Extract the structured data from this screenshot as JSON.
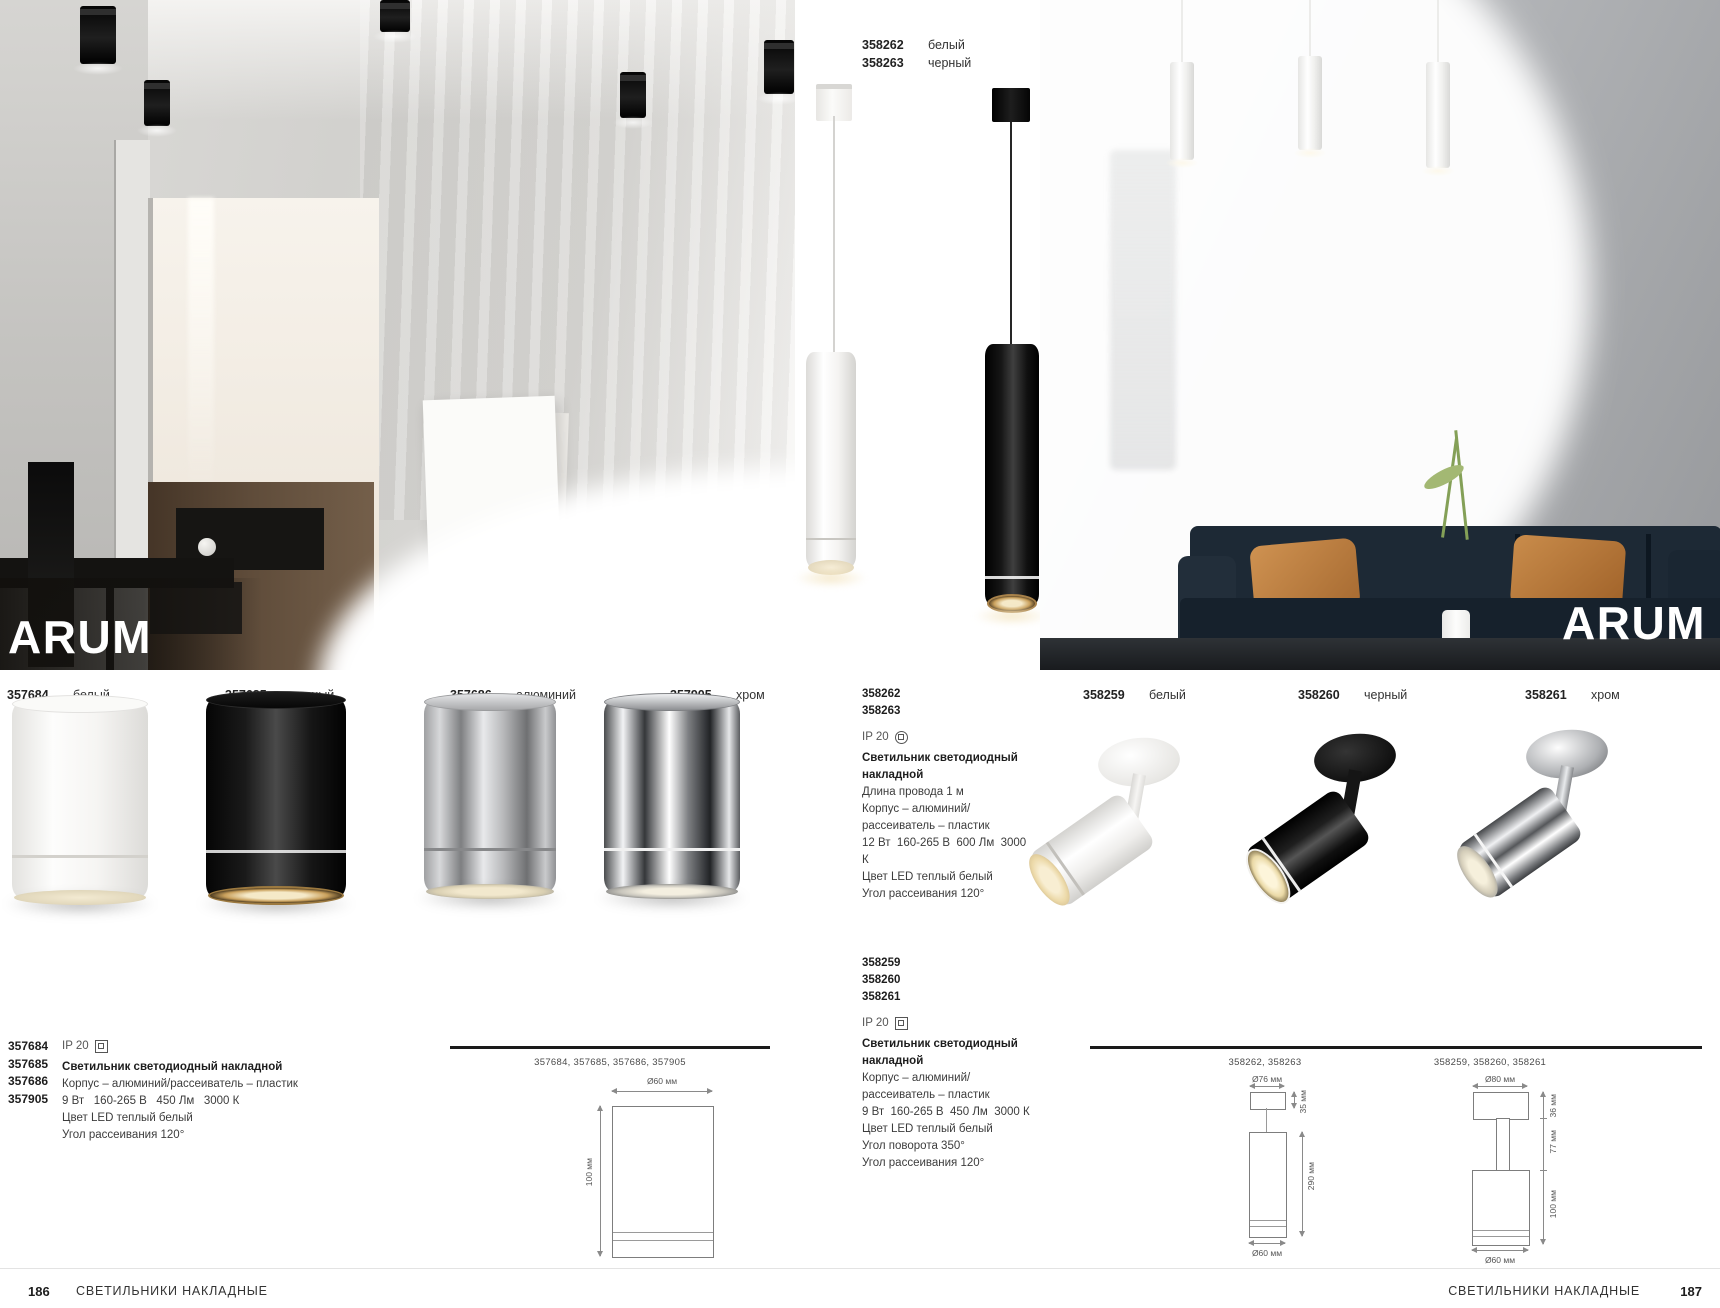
{
  "brand": {
    "name": "ARUM"
  },
  "left_products": [
    {
      "code": "357684",
      "finish": "белый"
    },
    {
      "code": "357685",
      "finish": "черный"
    },
    {
      "code": "357686",
      "finish": "алюминий"
    },
    {
      "code": "357905",
      "finish": "хром"
    }
  ],
  "pendant_products": [
    {
      "code": "358262",
      "finish": "белый"
    },
    {
      "code": "358263",
      "finish": "черный"
    }
  ],
  "right_products": [
    {
      "code": "358259",
      "finish": "белый"
    },
    {
      "code": "358260",
      "finish": "черный"
    },
    {
      "code": "358261",
      "finish": "хром"
    }
  ],
  "left_spec": {
    "codes": [
      "357684",
      "357685",
      "357686",
      "357905"
    ],
    "ip": "IP 20",
    "title": "Светильник светодиодный накладной",
    "lines": [
      "Корпус – алюминий/рассеиватель – пластик",
      "9 Вт   160-265 В   450 Лм   3000 К",
      "Цвет LED теплый белый",
      "Угол рассеивания 120°"
    ]
  },
  "pendant_spec": {
    "codes": [
      "358262",
      "358263"
    ],
    "ip": "IP 20",
    "title": "Светильник светодиодный накладной",
    "lines": [
      "Длина провода 1 м",
      "Корпус – алюминий/",
      "рассеиватель – пластик",
      "12 Вт  160-265 В  600 Лм  3000 К",
      "Цвет LED теплый белый",
      "Угол рассеивания 120°"
    ]
  },
  "spot_spec": {
    "codes": [
      "358259",
      "358260",
      "358261"
    ],
    "ip": "IP 20",
    "title": "Светильник светодиодный накладной",
    "lines": [
      "Корпус – алюминий/",
      "рассеиватель – пластик",
      "9 Вт  160-265 В  450 Лм  3000 К",
      "Цвет LED теплый белый",
      "Угол поворота 350°",
      "Угол рассеивания 120°"
    ]
  },
  "drawings": {
    "left": {
      "caption": "357684, 357685, 357686, 357905",
      "dim_width": "Ø60 мм",
      "dim_height": "100 мм"
    },
    "pendant": {
      "caption": "358262, 358263",
      "dim_top": "Ø76 мм",
      "dim_canopy": "35 мм",
      "dim_body": "290 мм",
      "dim_bottom": "Ø60 мм"
    },
    "spot": {
      "caption": "358259, 358260, 358261",
      "dim_top": "Ø80 мм",
      "dim_canopy": "36 мм",
      "dim_stem": "77 мм",
      "dim_body": "100 мм",
      "dim_bottom": "Ø60 мм"
    }
  },
  "footer_left": {
    "page": "186",
    "label": "СВЕТИЛЬНИКИ НАКЛАДНЫЕ"
  },
  "footer_right": {
    "page": "187",
    "label": "СВЕТИЛЬНИКИ НАКЛАДНЫЕ"
  },
  "colors": {
    "page_bg": "#ffffff",
    "ink": "#222222",
    "spec_text": "#3c3c3c",
    "warm_glow": "#f2e3bd",
    "sofa_navy": "#1d2935",
    "pillow_orange": "#c08448",
    "wall_gray": "#c9c8c5"
  }
}
